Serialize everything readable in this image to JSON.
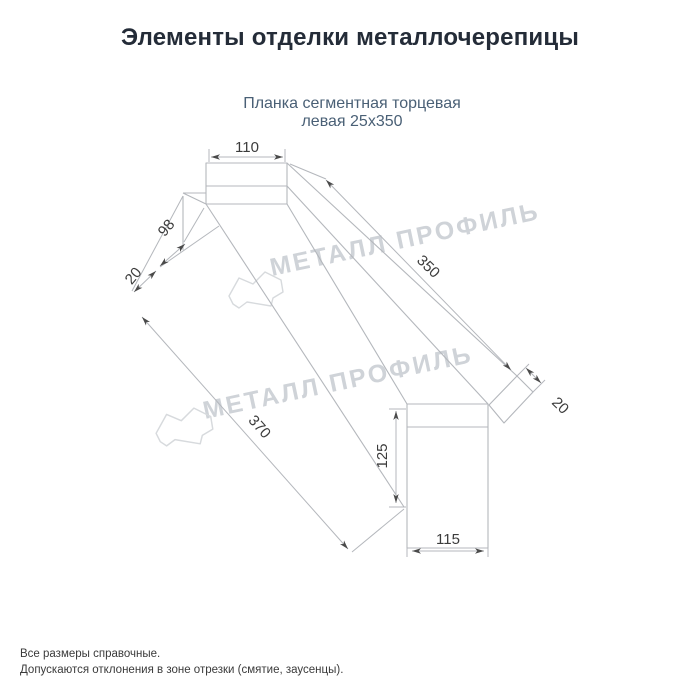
{
  "header": {
    "title": "Элементы отделки металлочерепицы"
  },
  "product": {
    "subtitle_line1": "Планка сегментная торцевая",
    "subtitle_line2": "левая 25х350"
  },
  "drawing": {
    "type": "isometric-technical-drawing",
    "dimensions": {
      "top_width": "110",
      "side_flange": "98",
      "left_hem": "20",
      "top_length": "350",
      "bottom_length": "370",
      "right_hem": "20",
      "end_height": "125",
      "end_width": "115"
    }
  },
  "watermark": {
    "text": "МЕТАЛЛ ПРОФИЛЬ",
    "logo": "metall-profil-cloud-logo"
  },
  "footer": {
    "line1": "Все размеры справочные.",
    "line2": "Допускаются отклонения в зоне отрезки (смятие, заусенцы)."
  },
  "colors": {
    "background": "#ffffff",
    "title": "#242c38",
    "subtitle": "#4a6076",
    "drawing_lines": "#b4b7bc",
    "dimension_text": "#3c3c3c",
    "arrowheads": "#4a4a4a",
    "watermark": "#cfd3d8",
    "footer_text": "#3a3a3a"
  }
}
